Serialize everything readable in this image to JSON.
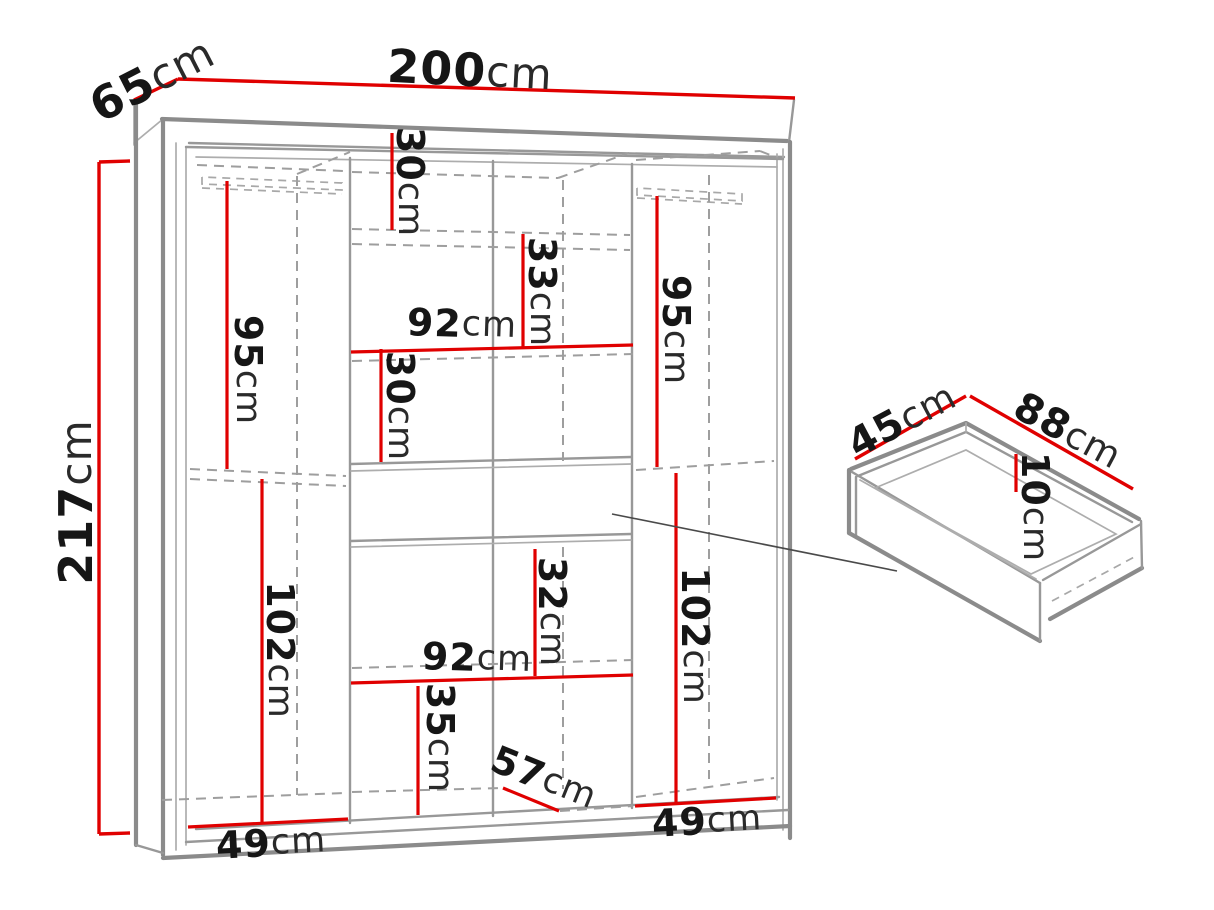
{
  "diagram": {
    "type": "furniture-dimension-drawing",
    "items": [
      "wardrobe",
      "drawer-detail"
    ],
    "colors": {
      "dimension_line_red": "#e00000",
      "outline_gray": "#8b8b8b",
      "hidden_line_gray": "#9e9e9e",
      "label_black": "#161616",
      "background": "#ffffff"
    },
    "unit": "cm"
  },
  "dims": {
    "d217": {
      "value": "217",
      "unit": "cm"
    },
    "d65": {
      "value": "65",
      "unit": "cm"
    },
    "d200": {
      "value": "200",
      "unit": "cm"
    },
    "d95l": {
      "value": "95",
      "unit": "cm"
    },
    "d30a": {
      "value": "30",
      "unit": "cm"
    },
    "d33": {
      "value": "33",
      "unit": "cm"
    },
    "d92a": {
      "value": "92",
      "unit": "cm"
    },
    "d30b": {
      "value": "30",
      "unit": "cm"
    },
    "d95r": {
      "value": "95",
      "unit": "cm"
    },
    "d32": {
      "value": "32",
      "unit": "cm"
    },
    "d102r": {
      "value": "102",
      "unit": "cm"
    },
    "d92b": {
      "value": "92",
      "unit": "cm"
    },
    "d35": {
      "value": "35",
      "unit": "cm"
    },
    "d57": {
      "value": "57",
      "unit": "cm"
    },
    "d49l": {
      "value": "49",
      "unit": "cm"
    },
    "d49r": {
      "value": "49",
      "unit": "cm"
    },
    "d102l": {
      "value": "102",
      "unit": "cm"
    },
    "d45": {
      "value": "45",
      "unit": "cm"
    },
    "d88": {
      "value": "88",
      "unit": "cm"
    },
    "d10": {
      "value": "10",
      "unit": "cm"
    }
  }
}
